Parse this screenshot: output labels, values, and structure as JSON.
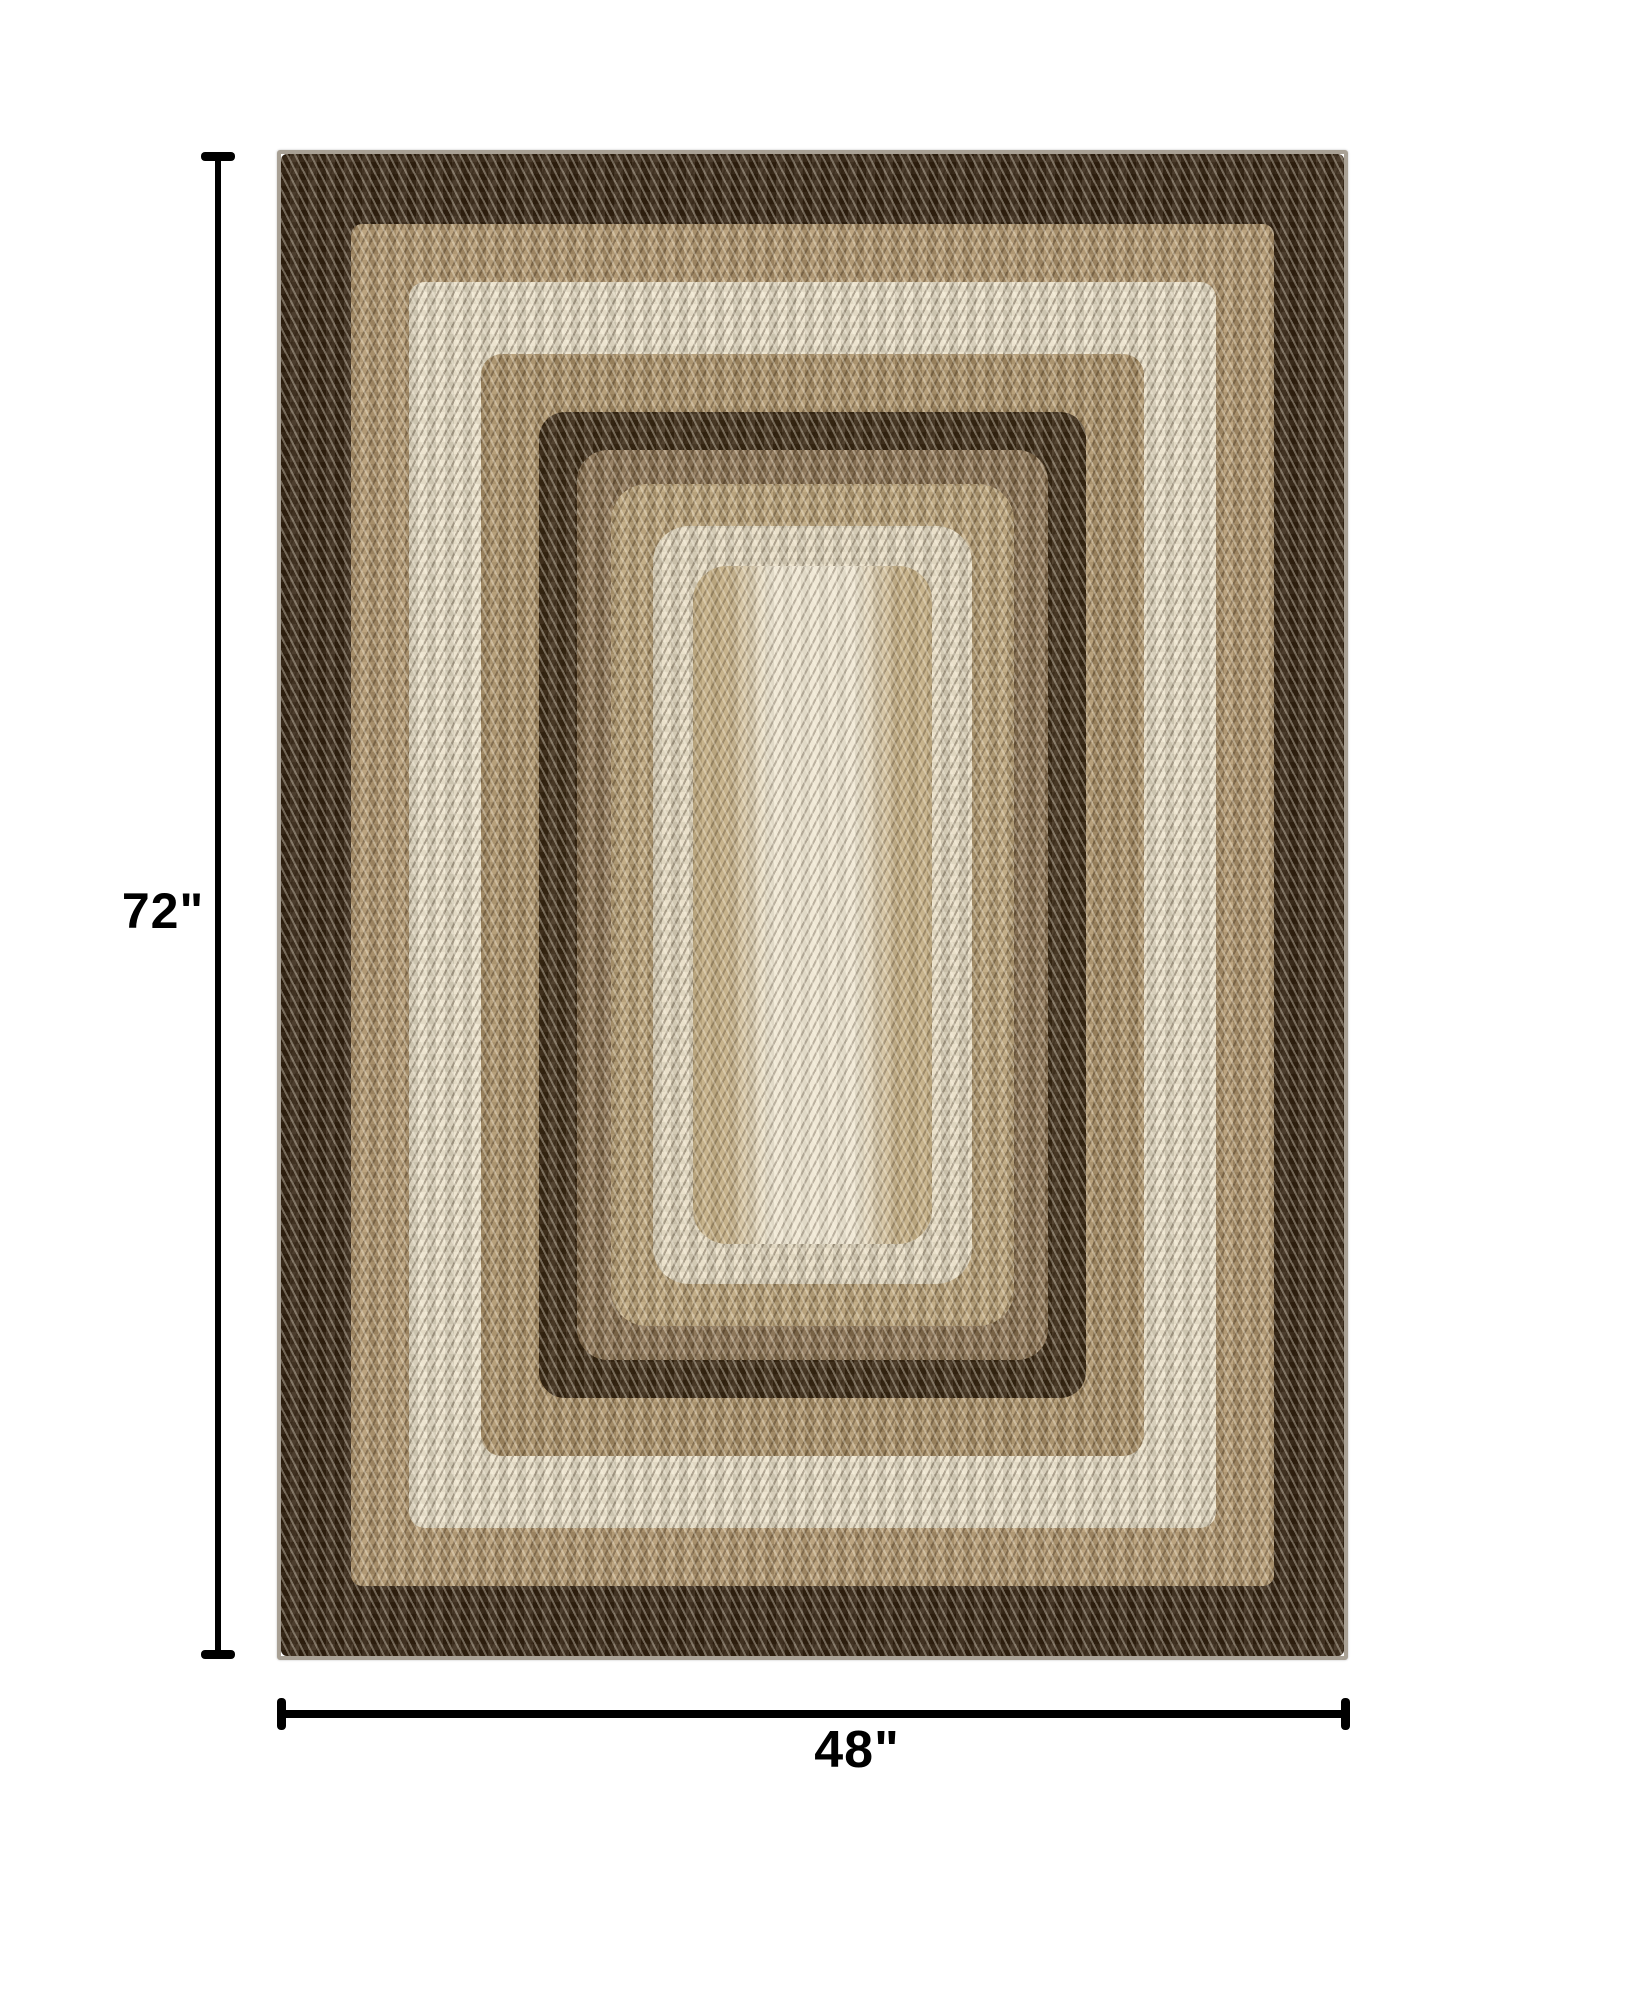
{
  "canvas": {
    "width": 1626,
    "height": 2007,
    "background": "#ffffff"
  },
  "annotations": {
    "height_label": "72\"",
    "width_label": "48\"",
    "line_color": "#000000",
    "label_color": "#000000"
  },
  "rug": {
    "description": "Rectangular braided area rug photographed top-down, concentric rectangular bands of dark brown, tan and cream with chevron braid texture",
    "binding_color": "#a8a094",
    "bands": [
      {
        "name": "outer-dark-band",
        "color": "#33220f",
        "width": 70
      },
      {
        "name": "tan-band-1",
        "color": "#b2976e",
        "width": 58
      },
      {
        "name": "cream-ring-outer",
        "color": "#ebe1c9",
        "width": 72
      },
      {
        "name": "tan-band-2",
        "color": "#ad9268",
        "width": 58
      },
      {
        "name": "inner-dark-ring",
        "color": "#3a2812",
        "width": 38
      },
      {
        "name": "brown-mottled-band",
        "color": "#8a7150",
        "width": 34
      },
      {
        "name": "tan-band-3",
        "color": "#bba277",
        "width": 42
      },
      {
        "name": "cream-ring-inner",
        "color": "#e7dcc3",
        "width": 40
      }
    ],
    "center": {
      "base_color": "#c4ae85",
      "column_color": "#efe7d3"
    }
  }
}
